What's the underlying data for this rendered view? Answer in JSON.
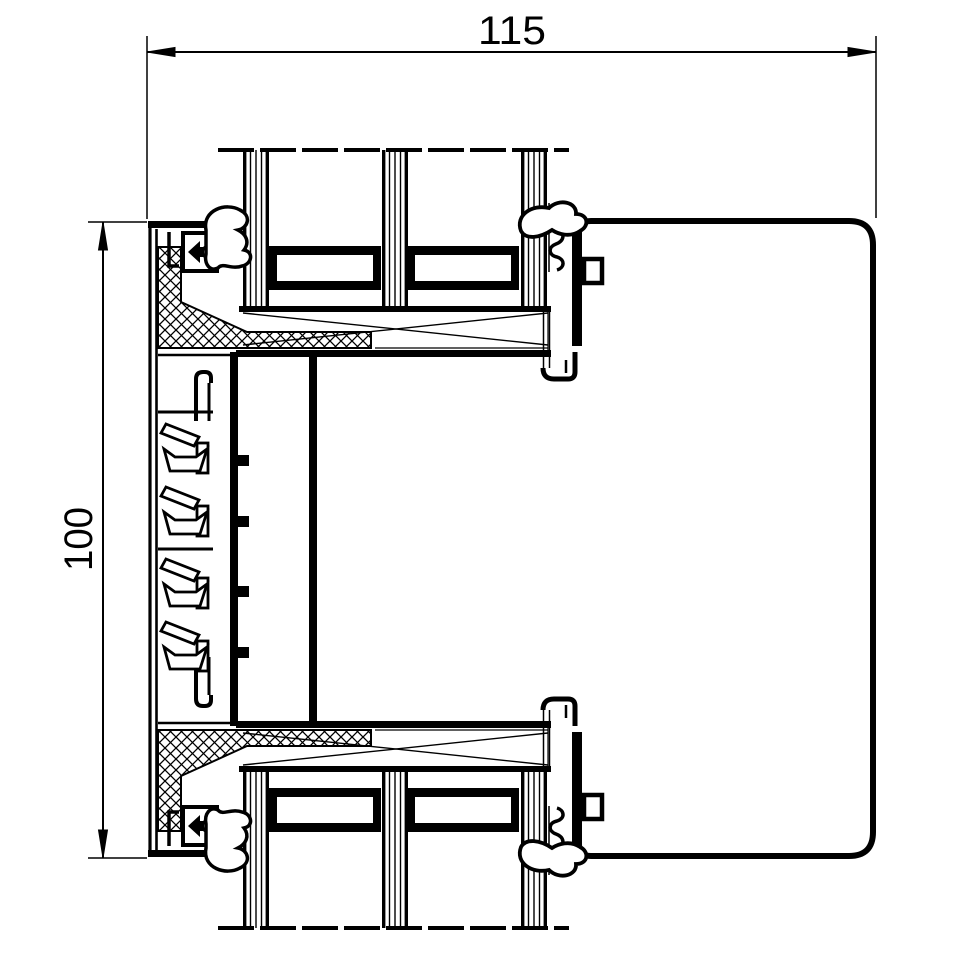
{
  "page": {
    "background": "#ffffff",
    "line_color": "#000000",
    "description": "CAD cross-section drawing of an aluminium window/facade profile with insulated triple glazing"
  },
  "drawing": {
    "type": "technical-section",
    "labels": {
      "width_dimension": "115",
      "height_dimension": "100"
    }
  }
}
